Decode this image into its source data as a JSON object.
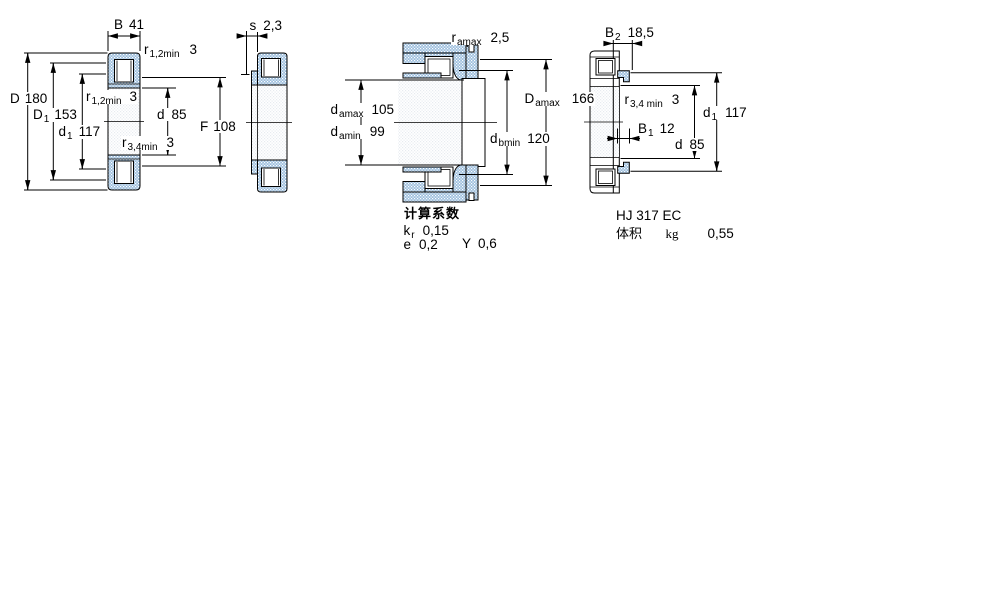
{
  "drawing": {
    "views": {
      "main_section": {
        "dims": {
          "B": {
            "sym": "B",
            "val": "41"
          },
          "r12_top": {
            "sym": "r",
            "sub": "1,2min",
            "val": "3"
          },
          "D": {
            "sym": "D",
            "val": "180"
          },
          "D1": {
            "sym": "D",
            "sub": "1",
            "val": "153"
          },
          "r12_mid": {
            "sym": "r",
            "sub": "1,2min",
            "val": "3"
          },
          "d1": {
            "sym": "d",
            "sub": "1",
            "val": "117"
          },
          "d": {
            "sym": "d",
            "val": "85"
          },
          "r34": {
            "sym": "r",
            "sub": "3,4min",
            "val": "3"
          },
          "F": {
            "sym": "F",
            "val": "108"
          }
        }
      },
      "side_section": {
        "dims": {
          "s": {
            "sym": "s",
            "val": "2,3"
          }
        }
      },
      "mounting": {
        "dims": {
          "r_amax": {
            "sym": "r",
            "sub": "amax",
            "val": "2,5"
          },
          "d_amax": {
            "sym": "d",
            "sub": "amax",
            "val": "105"
          },
          "d_amin": {
            "sym": "d",
            "sub": "amin",
            "val": "99"
          },
          "D_amax": {
            "sym": "D",
            "sub": "amax",
            "val": "166"
          },
          "d_bmin": {
            "sym": "d",
            "sub": "bmin",
            "val": "120"
          }
        },
        "calculation_factors": {
          "title": "计算系数",
          "kr": {
            "sym": "k",
            "sub": "r",
            "val": "0,15"
          },
          "e": {
            "sym": "e",
            "val": "0,2"
          },
          "Y": {
            "sym": "Y",
            "val": "0,6"
          }
        }
      },
      "angle_ring": {
        "designation": "HJ 317 EC",
        "dims": {
          "B2": {
            "sym": "B",
            "sub": "2",
            "val": "18,5"
          },
          "r34": {
            "sym": "r",
            "sub": "3,4 min",
            "val": "3"
          },
          "B1": {
            "sym": "B",
            "sub": "1",
            "val": "12"
          },
          "d": {
            "sym": "d",
            "val": "85"
          },
          "d1": {
            "sym": "d",
            "sub": "1",
            "val": "117"
          }
        },
        "mass": {
          "label": "体积",
          "unit": "kg",
          "val": "0,55"
        }
      }
    },
    "colors": {
      "section_fill_base": "#9dbedd",
      "line": "#000000"
    }
  }
}
